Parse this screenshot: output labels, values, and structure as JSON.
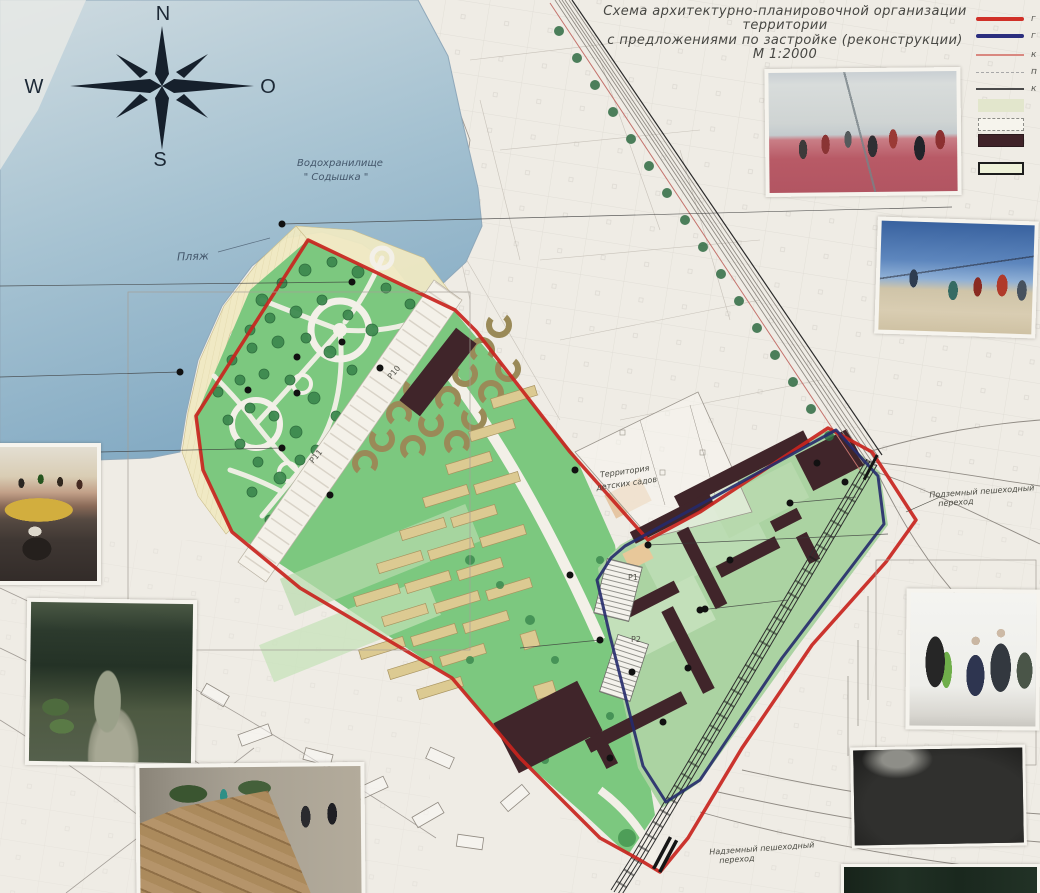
{
  "title": {
    "line1": "Схема архитектурно-планировочной организации",
    "line2": "территории",
    "line3": "с предложениями по застройке (реконструкции)",
    "line4": "М 1:2000"
  },
  "compass": {
    "north": "N",
    "south": "S",
    "west": "W",
    "east": "O"
  },
  "legend": {
    "line_items": [
      {
        "name": "thick-red-boundary-line",
        "color": "#d03028",
        "label_fragment": "г"
      },
      {
        "name": "thick-navy-boundary-line",
        "color": "#2b2e7e",
        "label_fragment": "г"
      },
      {
        "name": "thin-red-line",
        "color": "#d98880",
        "label_fragment": "к"
      },
      {
        "name": "thin-dashed-gray-line",
        "color": "#a8a8a8",
        "label_fragment": "п"
      },
      {
        "name": "thin-dark-line",
        "color": "#4a4a4a",
        "label_fragment": "к"
      }
    ],
    "swatch_items": [
      {
        "name": "pale-green-area",
        "fill": "#e2e6cc"
      },
      {
        "name": "dashed-outline-area",
        "fill": "#f6f4ed"
      },
      {
        "name": "existing-dark-building",
        "fill": "#402329"
      },
      {
        "name": "outlined-proposed-building",
        "fill": "#eef1d9"
      }
    ]
  },
  "labels": {
    "reservoir_line1": "Водохранилище",
    "reservoir_line2": "\" Содышка \"",
    "beach": "Пляж",
    "kindergarten_line1": "Территория",
    "kindergarten_line2": "детских садов",
    "underground_line1": "Подземный пешеходный",
    "underground_line2": "переход",
    "overpass_line1": "Надземный пешеходный",
    "overpass_line2": "переход"
  },
  "parking": {
    "p10": "Р10",
    "p11": "Р11",
    "p1": "Р1",
    "p2": "Р2"
  },
  "map_colors": {
    "water": "#9dbcce",
    "beach": "#efe9c2",
    "park_green": "#7cc87f",
    "residential_green": "#abd3a2",
    "existing_building": "#40252a",
    "proposed_building_tan": "#dcca92",
    "project_boundary_red": "#c8241e",
    "design_boundary_navy": "#252a6b"
  },
  "photos": [
    {
      "id": "basketball-court",
      "desc": "Streetball game on red court"
    },
    {
      "id": "beach-volleyball",
      "desc": "Beach volleyball game on sand"
    },
    {
      "id": "skatepark",
      "desc": "Skatepark with jumping riders at sunset"
    },
    {
      "id": "stone-path",
      "desc": "Flagstone garden path in greenery"
    },
    {
      "id": "urban-deck-benches",
      "desc": "Wooden lounge decks on promenade"
    },
    {
      "id": "outdoor-gym",
      "desc": "People on outdoor exercise equipment"
    },
    {
      "id": "dark-landscape",
      "desc": "Dark rocky landscape"
    },
    {
      "id": "forest-strip",
      "desc": "Dark forest greenery"
    }
  ]
}
